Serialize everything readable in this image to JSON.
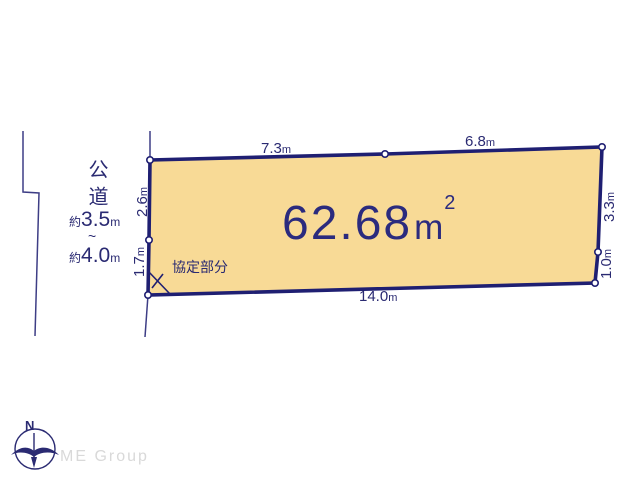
{
  "colors": {
    "parcel_fill": "#f8da96",
    "outline_navy": "#1f1f72",
    "text_navy": "#2b2b7e",
    "dim_text_navy": "#2a2a72",
    "thin_line": "#3d3d85",
    "watermark_gray": "#d9d9d9"
  },
  "parcel": {
    "area": {
      "value": "62.68",
      "unit": "m",
      "superscript": "2"
    },
    "dimensions": [
      {
        "id": "top-left-segment",
        "value": "7.3",
        "unit": "m"
      },
      {
        "id": "top-right-segment",
        "value": "6.8",
        "unit": "m"
      },
      {
        "id": "left-upper-segment",
        "value": "2.6",
        "unit": "m"
      },
      {
        "id": "left-lower-segment",
        "value": "1.7",
        "unit": "m"
      },
      {
        "id": "right-upper-segment",
        "value": "3.3",
        "unit": "m"
      },
      {
        "id": "right-lower-segment",
        "value": "1.0",
        "unit": "m"
      },
      {
        "id": "bottom-segment",
        "value": "14.0",
        "unit": "m"
      }
    ],
    "agreement_label": "協定部分"
  },
  "road": {
    "name": "公道",
    "width_min": {
      "prefix": "約",
      "value": "3.5",
      "unit": "m"
    },
    "tilde": "~",
    "width_max": {
      "prefix": "約",
      "value": "4.0",
      "unit": "m"
    }
  },
  "compass": {
    "north_label": "N"
  },
  "watermark": {
    "text": "ME Group"
  }
}
